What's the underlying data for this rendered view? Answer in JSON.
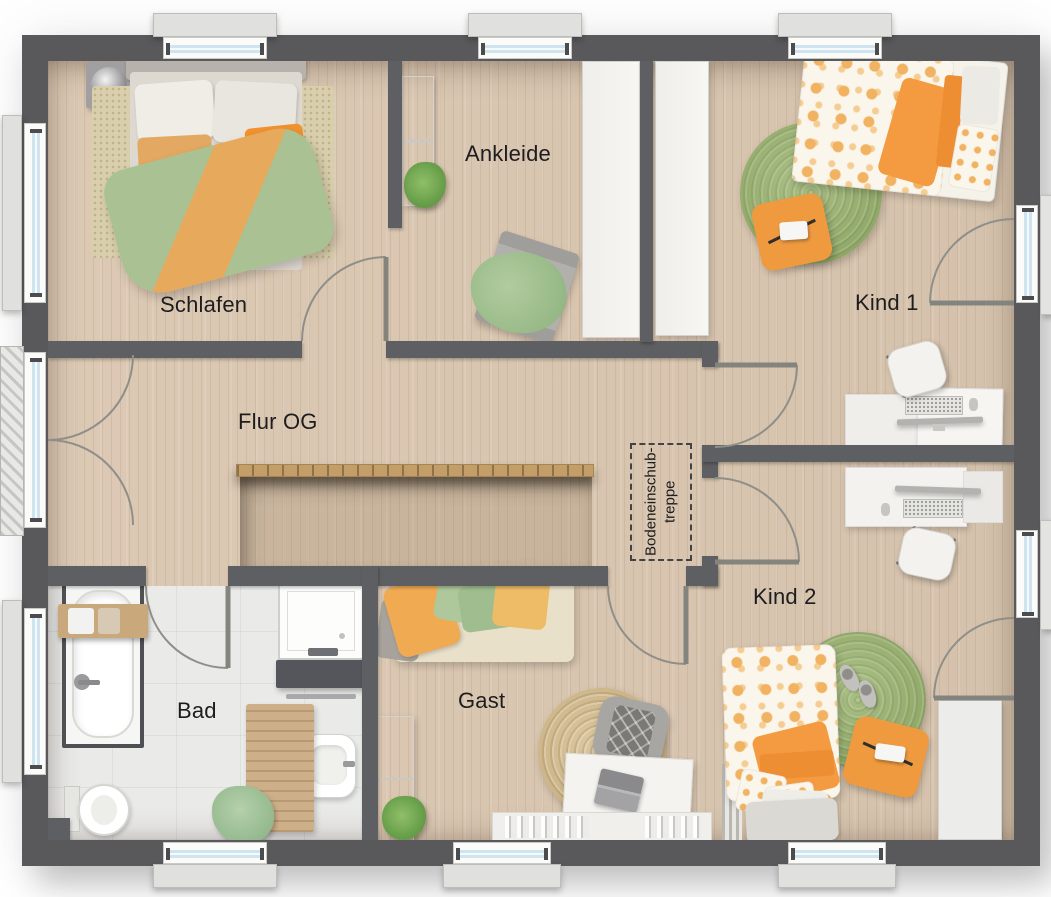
{
  "rooms": [
    {
      "id": "schlafen",
      "label": "Schlafen"
    },
    {
      "id": "ankleide",
      "label": "Ankleide"
    },
    {
      "id": "kind-1",
      "label": "Kind 1"
    },
    {
      "id": "flur-og",
      "label": "Flur OG"
    },
    {
      "id": "bad",
      "label": "Bad"
    },
    {
      "id": "gast",
      "label": "Gast"
    },
    {
      "id": "kind-2",
      "label": "Kind 2"
    }
  ],
  "attic_stairs": {
    "line1": "Bodeneinschub-",
    "line2": "treppe"
  },
  "colors": {
    "wall": "#59595c",
    "wood_floor": "#d8c5b0",
    "bath_floor": "#eaeae8",
    "window_glass": "#cfe4ee",
    "railing_wood": "#c39e68",
    "accent_orange": "#ef9a3f",
    "accent_green": "#a9c295",
    "rug_green": "#9fb478",
    "rug_jute": "#d3bd95"
  }
}
